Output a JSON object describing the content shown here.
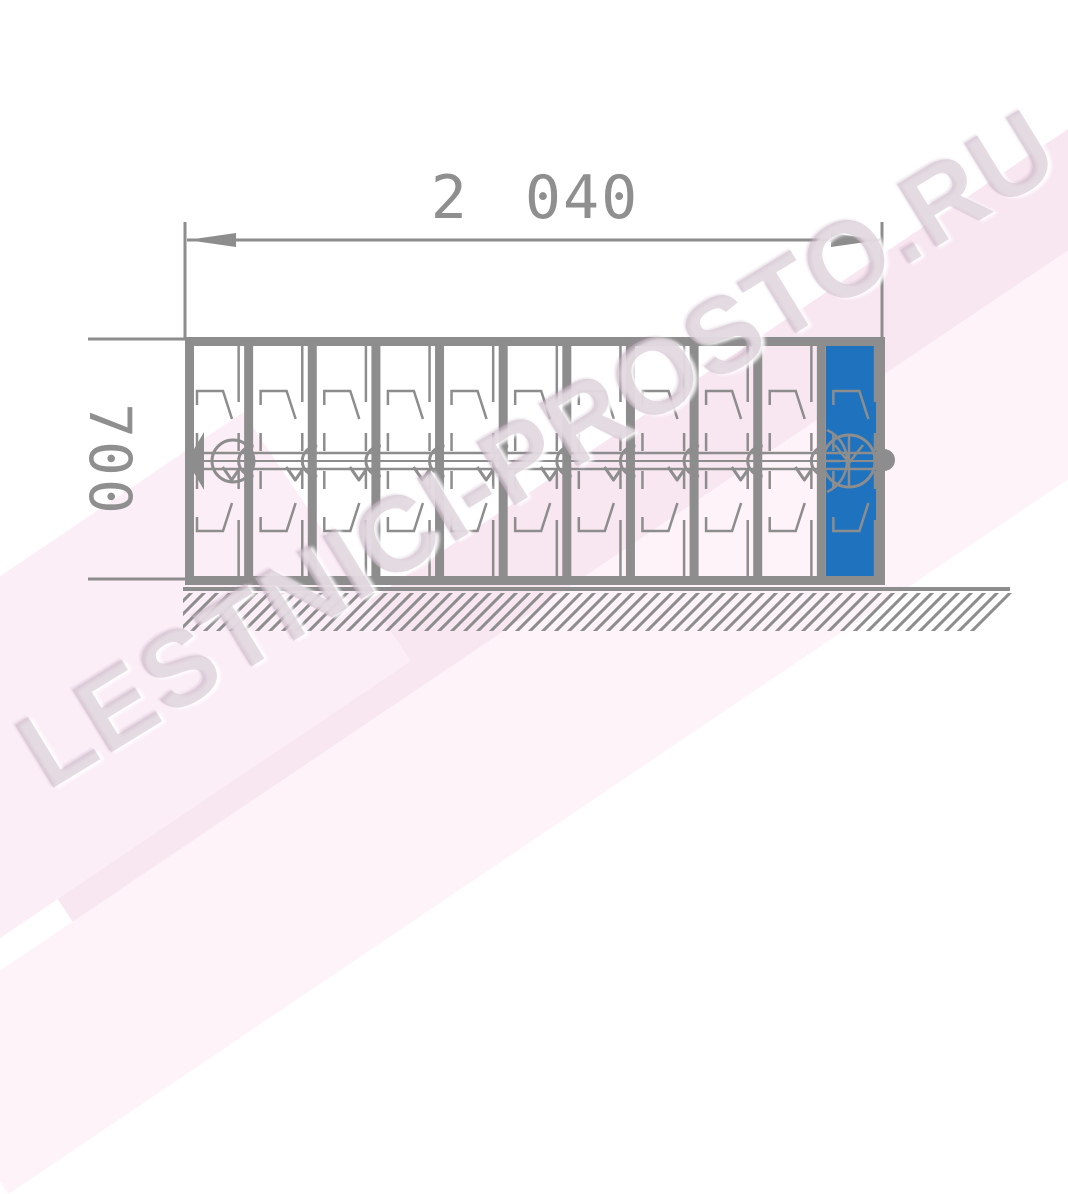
{
  "dimensions": {
    "width_label": "2 040",
    "height_label": "700"
  },
  "watermark": {
    "text": "LESTNICI-PROSTO.RU"
  },
  "drawing": {
    "type": "technical-drawing",
    "subject": "folded-attic-ladder-section-side-view-on-ground",
    "section_count": 11,
    "highlighted_section_index": 10,
    "colors": {
      "line": "#8d8d8d",
      "highlight_fill": "#1f72bd",
      "dimension_text": "#8f8f8f",
      "watermark": "rgba(203,186,200,0.5)",
      "bg_band_primary": "#f8e6f1",
      "bg_band_secondary": "#fdf3f9",
      "bg_band_corner": "#fbeef7"
    }
  }
}
